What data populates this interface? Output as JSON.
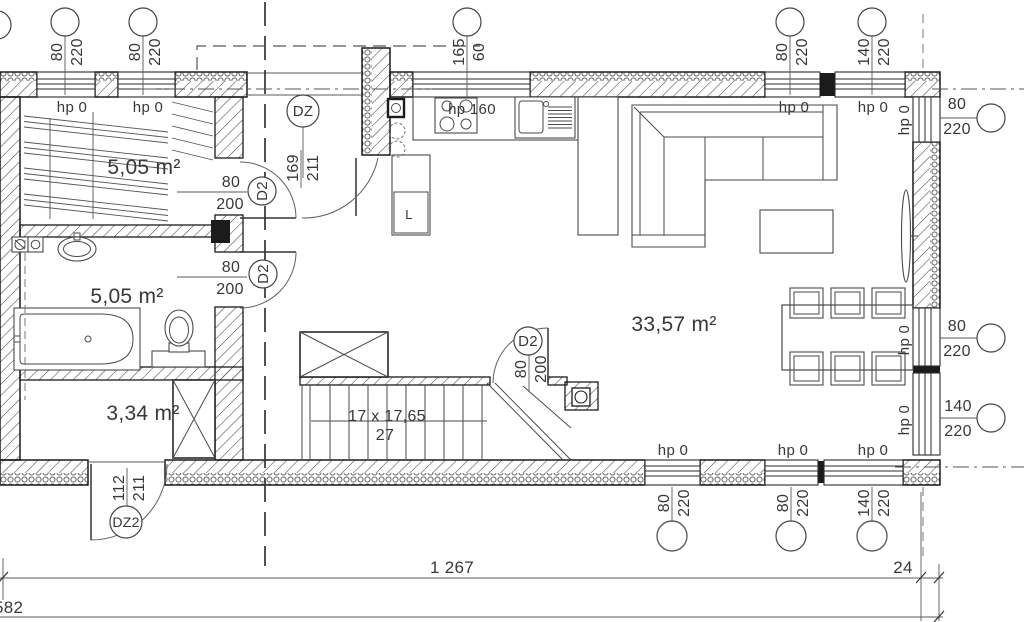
{
  "drawing": {
    "rooms": [
      {
        "id": "wardrobe",
        "area": "5,05 m²"
      },
      {
        "id": "bathroom",
        "area": "5,05 m²"
      },
      {
        "id": "wc",
        "area": "3,34 m²"
      },
      {
        "id": "living-kitchen",
        "area": "33,57 m²"
      }
    ],
    "stairs": {
      "run": "17 x 17,65",
      "width": "27"
    },
    "kitchen": {
      "fridge": "L"
    },
    "doors": [
      {
        "tag": "DZ",
        "width": "169",
        "height": "211"
      },
      {
        "tag": "D2",
        "width": "80",
        "height": "200"
      },
      {
        "tag": "D2",
        "width": "80",
        "height": "200"
      },
      {
        "tag": "D2",
        "width": "80",
        "height": "200"
      },
      {
        "tag": "DZ2",
        "width": "112",
        "height": "211"
      }
    ],
    "windows": [
      {
        "width": "80",
        "height": "220",
        "parapet": "hp 0"
      },
      {
        "width": "80",
        "height": "220",
        "parapet": "hp 0"
      },
      {
        "width": "165",
        "height": "60",
        "parapet": "hp 160"
      },
      {
        "width": "80",
        "height": "220",
        "parapet": "hp 0"
      },
      {
        "width": "140",
        "height": "220",
        "parapet": "hp 0"
      },
      {
        "width": "80",
        "height": "220",
        "parapet": "hp 0"
      },
      {
        "width": "80",
        "height": "220",
        "parapet": "hp 0"
      },
      {
        "width": "140",
        "height": "220",
        "parapet": "hp 0"
      },
      {
        "width": "80",
        "height": "220",
        "parapet": "hp 0"
      },
      {
        "width": "80",
        "height": "220",
        "parapet": "hp 0"
      },
      {
        "width": "140",
        "height": "220",
        "parapet": "hp 0"
      }
    ],
    "dimensions": {
      "overall": "1 267",
      "wall": "24",
      "left": "582"
    }
  }
}
